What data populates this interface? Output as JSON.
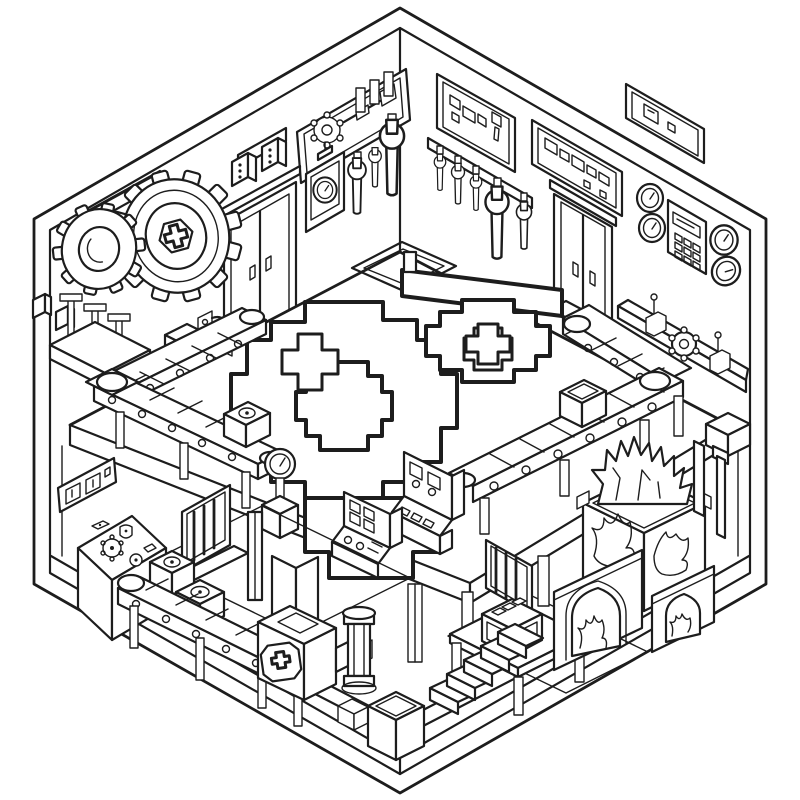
{
  "illustration": {
    "title": "Isometric blocky factory workshop cutaway line-art",
    "type": "isometric-line-art-coloring-page",
    "palette": {
      "background": "#ffffff",
      "line": "#1d1d1d"
    },
    "regions": {
      "left_wall": {
        "objects": [
          "wall-plaque-long",
          "wall-plaque-short",
          "control-panel-with-gear",
          "switch-blocks",
          "large-gear-with-cross-hub",
          "small-gear",
          "double-sliding-door",
          "wall-gauge-box",
          "hanging-wrenches",
          "lever-stand"
        ]
      },
      "right_wall": {
        "objects": [
          "pixel-icon-panel",
          "wrench-rack",
          "pixel-readout-panel",
          "corner-pixel-panel",
          "double-sliding-door",
          "round-gauges",
          "keypad-device",
          "wall-shelf-with-gear-and-levers"
        ]
      },
      "middle_floor": {
        "objects": [
          "floor-hatch",
          "pixel-emblem-with-crosses",
          "l-conveyor-left",
          "l-conveyor-right",
          "crates-on-belts",
          "mini-robot",
          "gauge-pedestal",
          "control-console-small",
          "control-console-large"
        ]
      },
      "ground_floor": {
        "objects": [
          "pixel-sign",
          "slanted-control-desk",
          "barred-window-left",
          "barred-window-right",
          "conveyor-with-gear-crates",
          "support-pillars",
          "flanged-pipe-column",
          "cross-screw-machine",
          "open-crate",
          "connector-block",
          "work-table",
          "digital-readout-device",
          "staircase",
          "furnace-with-flames",
          "furnace-arches",
          "standing-hammer"
        ]
      }
    }
  }
}
